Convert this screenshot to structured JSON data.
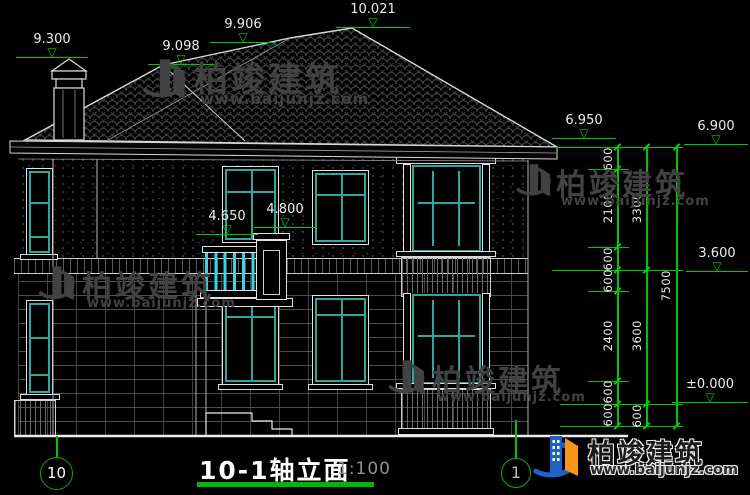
{
  "title": {
    "text": "10-1轴立面",
    "scale": "1:100"
  },
  "axes": {
    "left": "10",
    "right": "1"
  },
  "icons": {
    "level_triangle": "▽"
  },
  "levels": [
    {
      "id": "chimney-top",
      "value": "9.300"
    },
    {
      "id": "left-hip",
      "value": "9.098"
    },
    {
      "id": "ridge-left",
      "value": "9.906"
    },
    {
      "id": "ridge-peak",
      "value": "10.021"
    },
    {
      "id": "eave-front",
      "value": "6.950"
    },
    {
      "id": "eave-right",
      "value": "6.900"
    },
    {
      "id": "balcony-rail",
      "value": "4.650"
    },
    {
      "id": "balcony-pillar",
      "value": "4.800"
    },
    {
      "id": "second-floor",
      "value": "3.600"
    },
    {
      "id": "ground-floor",
      "value": "±0.000"
    }
  ],
  "dim_chains": {
    "inner": [
      "600",
      "2100",
      "600",
      "600",
      "2400",
      "600",
      "600"
    ],
    "middle": [
      "3300",
      "3600",
      "600"
    ],
    "outer": [
      "7500"
    ]
  },
  "watermark": {
    "brand": "柏竣建筑",
    "url": "www.baijunjz.com"
  },
  "colors": {
    "background": "#000000",
    "line_white": "#e8e8e8",
    "dim_green": "#00c400",
    "window_teal": "#2fa7a0",
    "baluster_cyan": "#35d6e0",
    "watermark_gray": "#424242",
    "logo_blue": "#1e63c4",
    "logo_orange": "#f7941d"
  }
}
